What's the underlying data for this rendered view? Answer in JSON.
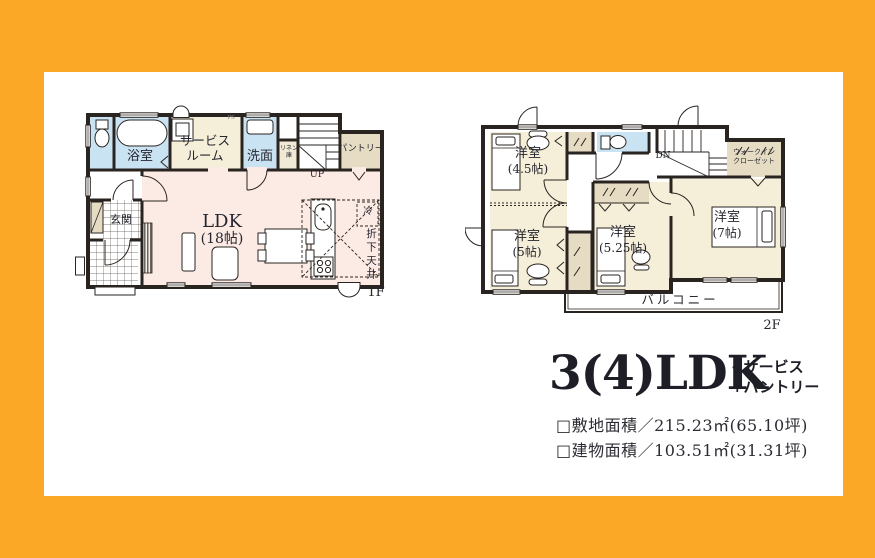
{
  "palette": {
    "frame_orange": "#FCA827",
    "wall": "#2A2420",
    "water_blue": "#C9E3F3",
    "room_cream": "#F5EFDA",
    "closet_beige": "#E5DCC3",
    "ldk_pink": "#FCEAE4"
  },
  "floor1": {
    "floor_label": "1F",
    "bath": "浴室",
    "service_room": [
      "サービス",
      "ルーム"
    ],
    "washroom": "洗面",
    "linen": [
      "リネン",
      "庫"
    ],
    "pantry": "パントリー",
    "ps": "PS",
    "stairs_up": "UP",
    "entrance": "玄関",
    "ldk_name": "LDK",
    "ldk_size": "(18帖)",
    "fridge": "冷",
    "dropped_ceiling": "折下天井"
  },
  "floor2": {
    "floor_label": "2F",
    "room_45": {
      "name": "洋室",
      "size": "(4.5帖)"
    },
    "room_5": {
      "name": "洋室",
      "size": "(5帖)"
    },
    "room_525": {
      "name": "洋室",
      "size": "(5.25帖)"
    },
    "room_7": {
      "name": "洋室",
      "size": "(7帖)"
    },
    "stairs_down": "DN",
    "walk_in_closet": [
      "ウォークイン",
      "クローゼット"
    ],
    "balcony": "バルコニー"
  },
  "summary": {
    "title": "3(4)LDK",
    "extras": [
      "+サービス",
      "+パントリー"
    ],
    "site_area": "□敷地面積／215.23㎡(65.10坪)",
    "building_area": "□建物面積／103.51㎡(31.31坪)"
  }
}
